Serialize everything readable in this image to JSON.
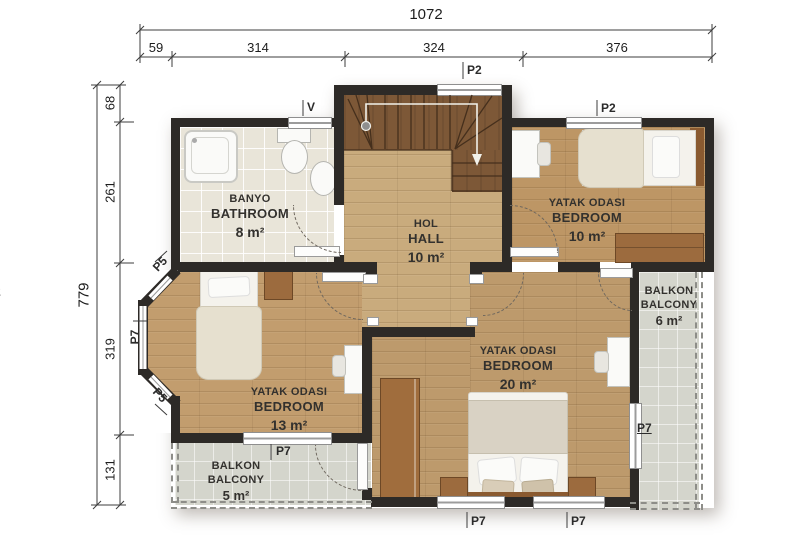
{
  "dimensions": {
    "top": {
      "total": "1072",
      "segments": [
        "59",
        "314",
        "324",
        "376"
      ]
    },
    "left": {
      "total": "779",
      "segments": [
        "68",
        "261",
        "319",
        "131"
      ]
    }
  },
  "rooms": {
    "bathroom": {
      "tr": "BANYO",
      "en": "BATHROOM",
      "area": "8 m²"
    },
    "hall": {
      "tr": "HOL",
      "en": "HALL",
      "area": "10 m²"
    },
    "bedroom_10": {
      "tr": "YATAK ODASI",
      "en": "BEDROOM",
      "area": "10 m²"
    },
    "balcony_6": {
      "tr": "BALKON",
      "en": "BALCONY",
      "area": "6 m²"
    },
    "bedroom_13": {
      "tr": "YATAK ODASI",
      "en": "BEDROOM",
      "area": "13 m²"
    },
    "bedroom_20": {
      "tr": "YATAK ODASI",
      "en": "BEDROOM",
      "area": "20 m²"
    },
    "balcony_5": {
      "tr": "BALKON",
      "en": "BALCONY",
      "area": "5 m²"
    }
  },
  "labels": {
    "vent": "V",
    "p2_stair": "P2",
    "p2_bedroom": "P2",
    "p5_bay_upper": "P5",
    "p7_bay": "P7",
    "p5_bay_lower": "P5",
    "p7_balcony5": "P7",
    "p7_bottom_1": "P7",
    "p7_bottom_2": "P7",
    "p7_balcony6": "P7",
    "edge_partial": "2"
  },
  "colors": {
    "wall": "#2d2a27",
    "wood_floor": "#c2a06f",
    "stair_wood": "#7d5837",
    "bathroom_tile": "#e9e5d9",
    "balcony_tile": "#d4d5cc",
    "furniture_wood": "#9c6b3e"
  }
}
